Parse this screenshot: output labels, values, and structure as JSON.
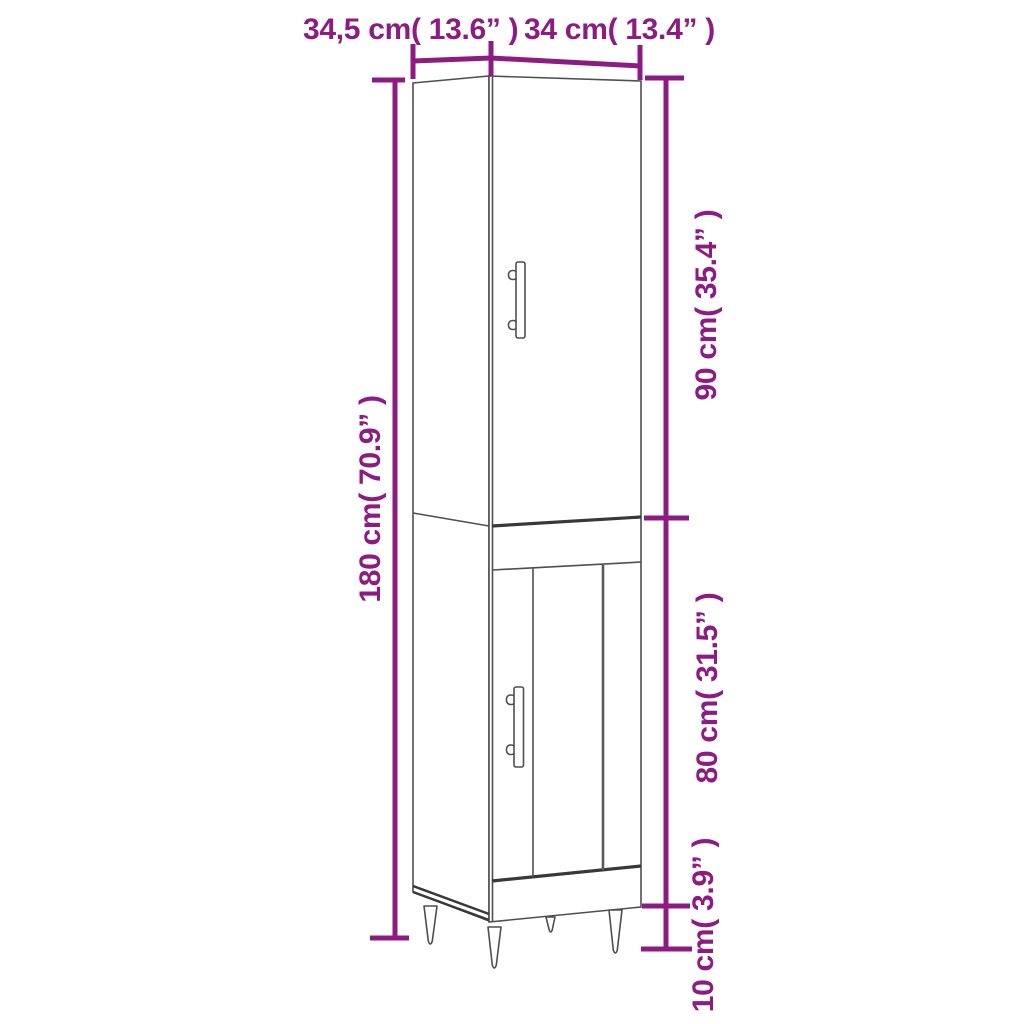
{
  "page": {
    "type": "product-dimension-diagram",
    "subject": "tall narrow cabinet line drawing with two doors, vertical bar handles and four tapered legs",
    "background": "#ffffff"
  },
  "palette": {
    "dimension_color": "#8E1B82",
    "line_color": "#4F4F4F",
    "shadow_line_color": "#383838"
  },
  "labels": {
    "top_depth": "34,5 cm( 13.6” )",
    "top_width": "34 cm( 13.4” )",
    "left_total_height": "180 cm( 70.9” )",
    "right_upper_height": "90 cm( 35.4” )",
    "right_middle_height": "80 cm( 31.5” )",
    "right_leg_height": "10 cm( 3.9” )"
  },
  "measurements": [
    {
      "position": "top-left-span",
      "cm": "34,5",
      "inch": "13.6”",
      "label": "34,5 cm( 13.6” )"
    },
    {
      "position": "top-right-span",
      "cm": "34",
      "inch": "13.4”",
      "label": "34 cm( 13.4” )"
    },
    {
      "position": "left-full-height",
      "cm": "180",
      "inch": "70.9”",
      "label": "180 cm( 70.9” )"
    },
    {
      "position": "right-upper-section",
      "cm": "90",
      "inch": "35.4”",
      "label": "90 cm( 35.4” )"
    },
    {
      "position": "right-lower-section",
      "cm": "80",
      "inch": "31.5”",
      "label": "80 cm( 31.5” )"
    },
    {
      "position": "right-legs-section",
      "cm": "10",
      "inch": "3.9”",
      "label": "10 cm( 3.9” )"
    }
  ]
}
